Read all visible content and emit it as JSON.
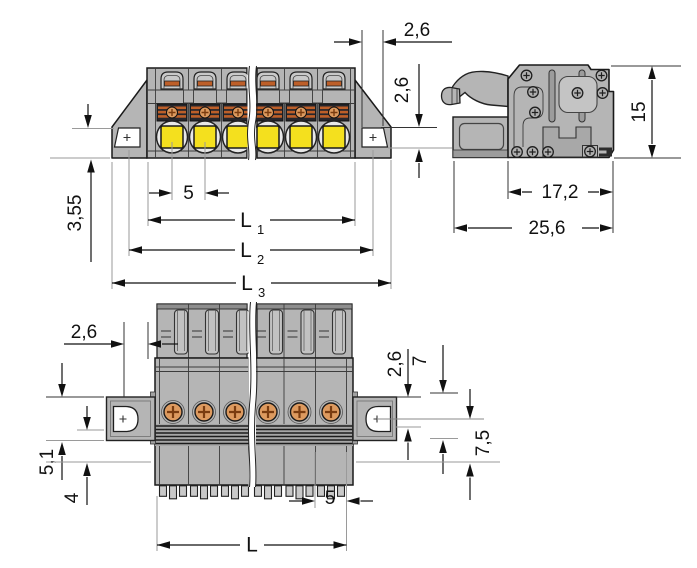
{
  "drawing": {
    "type": "connector-dimension-drawing",
    "views": {
      "front": "front view",
      "side": "side view",
      "bottom": "bottom view"
    }
  },
  "dims": {
    "front": {
      "flange_width": "2,6",
      "flange_thickness": "2,6",
      "base_height": "3,55",
      "pitch": "5",
      "l1": "L",
      "l1_sub": "1",
      "l2": "L",
      "l2_sub": "2",
      "l3": "L",
      "l3_sub": "3"
    },
    "side": {
      "height": "15",
      "depth": "17,2",
      "total_depth": "25,6"
    },
    "bottom": {
      "flange_width": "2,6",
      "offset_top": "2,6",
      "offset_seven": "7",
      "depth": "7,5",
      "offset_left_a": "5,1",
      "offset_left_b": "4",
      "pitch": "5",
      "length": "L"
    }
  },
  "colors": {
    "body_gray": "#b5b5b5",
    "body_gray_dark": "#9c9c9c",
    "body_gray_light": "#c9c9c9",
    "outline": "#1a1a1a",
    "button_yellow": "#f4e01e",
    "clamp_dark": "#26262c",
    "clamp_orange": "#bd5f29",
    "screw_copper": "#dd9a5f",
    "screw_cross": "#7a3c10",
    "ext_gray": "#9a9a9a",
    "background": "#ffffff"
  }
}
